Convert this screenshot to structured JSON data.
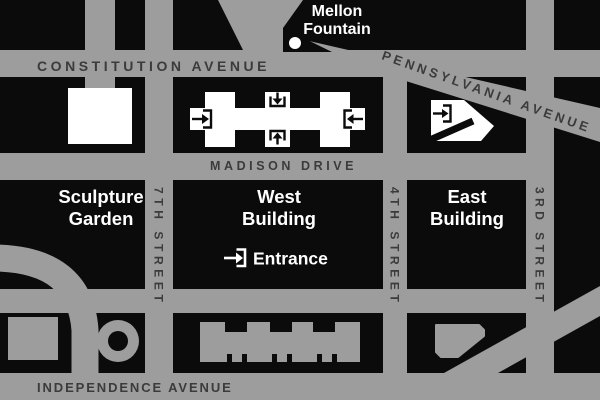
{
  "map": {
    "colors": {
      "street": "#9d9d9d",
      "block": "#0b0b0b",
      "building_white": "#ffffff",
      "street_label": "#3b3b3b"
    },
    "streets": {
      "constitution": "CONSTITUTION AVENUE",
      "madison": "MADISON DRIVE",
      "independence": "INDEPENDENCE AVENUE",
      "pennsylvania": "PENNSYLVANIA AVENUE",
      "seventh": "7TH STREET",
      "fourth": "4TH STREET",
      "third": "3RD STREET"
    },
    "places": {
      "mellon_line1": "Mellon",
      "mellon_line2": "Fountain",
      "sculpture_line1": "Sculpture",
      "sculpture_line2": "Garden",
      "west_line1": "West",
      "west_line2": "Building",
      "east_line1": "East",
      "east_line2": "Building",
      "entrance": "Entrance"
    }
  }
}
